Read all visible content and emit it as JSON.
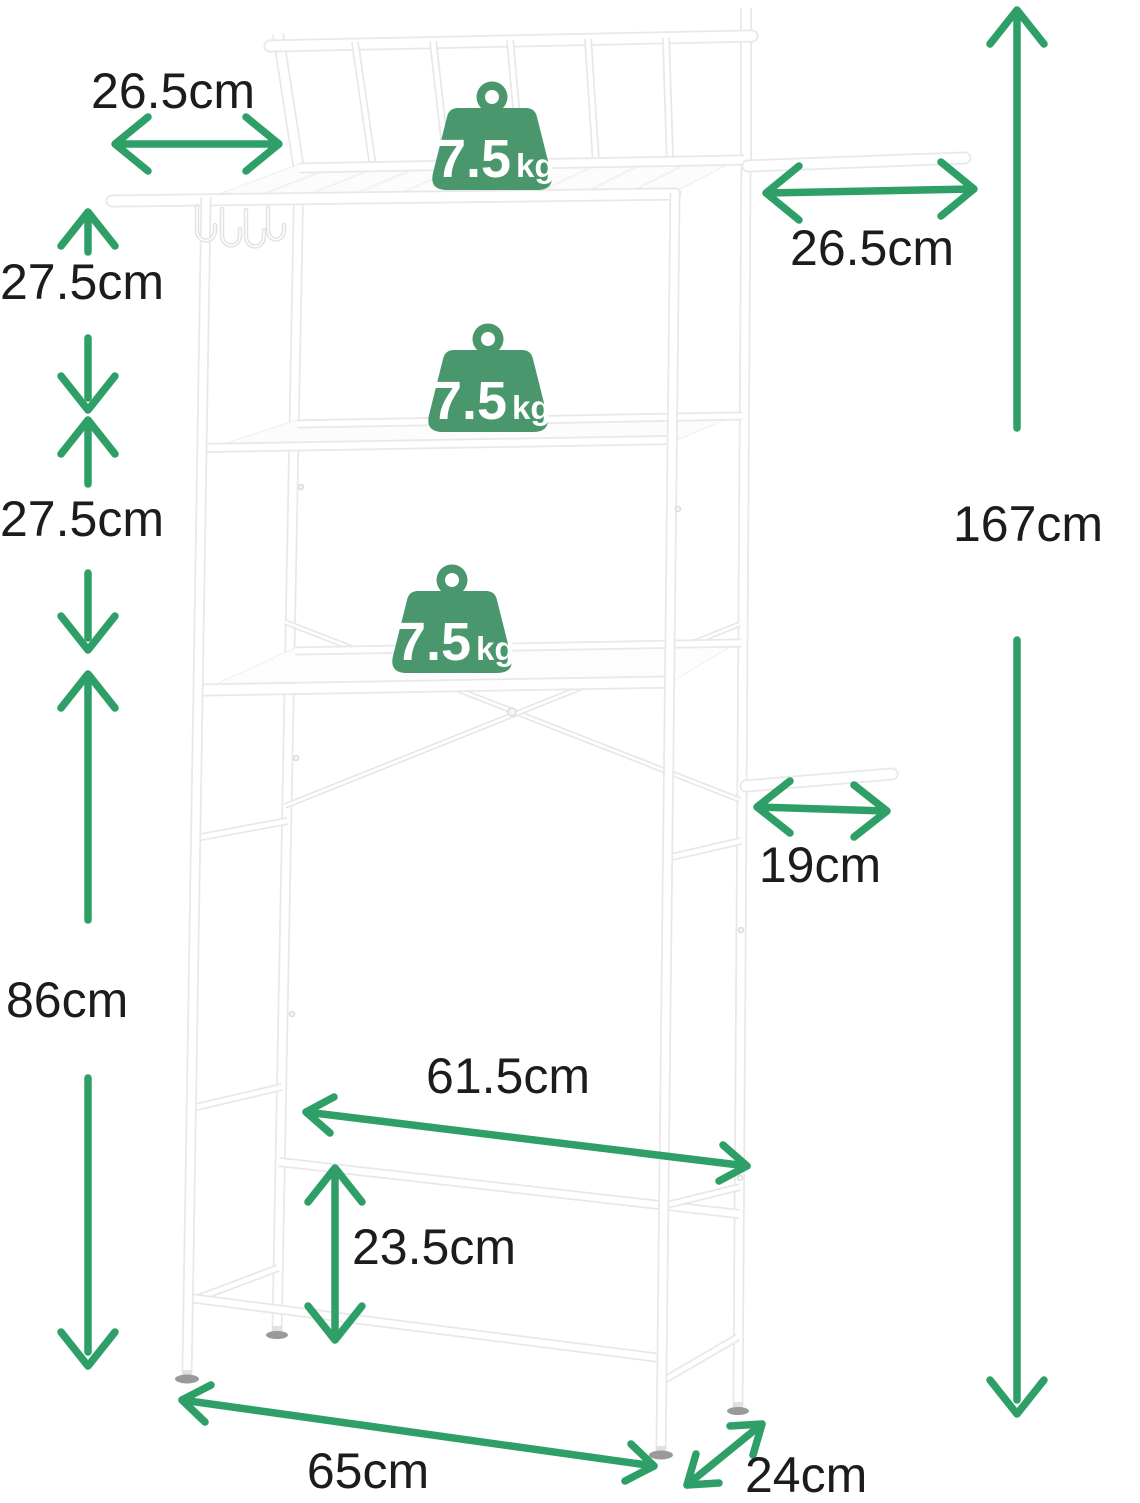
{
  "diagram": {
    "kind": "over-toilet-rack-dimension-diagram",
    "background": "#ffffff",
    "label_color": "#1c1c1c",
    "arrow_color": "#2f9f68",
    "icon_color": "#4a966d"
  },
  "capacity": {
    "value": "7.5",
    "unit": "kg",
    "count": 3
  },
  "dimensions": {
    "left_bar_length": "26.5cm",
    "right_bar_length": "26.5cm",
    "upper_shelf_gap": "27.5cm",
    "middle_shelf_gap": "27.5cm",
    "total_height": "167cm",
    "under_clearance": "86cm",
    "towel_bar_length": "19cm",
    "inner_width": "61.5cm",
    "bottom_bar_height": "23.5cm",
    "outer_width": "65cm",
    "depth": "24cm"
  }
}
